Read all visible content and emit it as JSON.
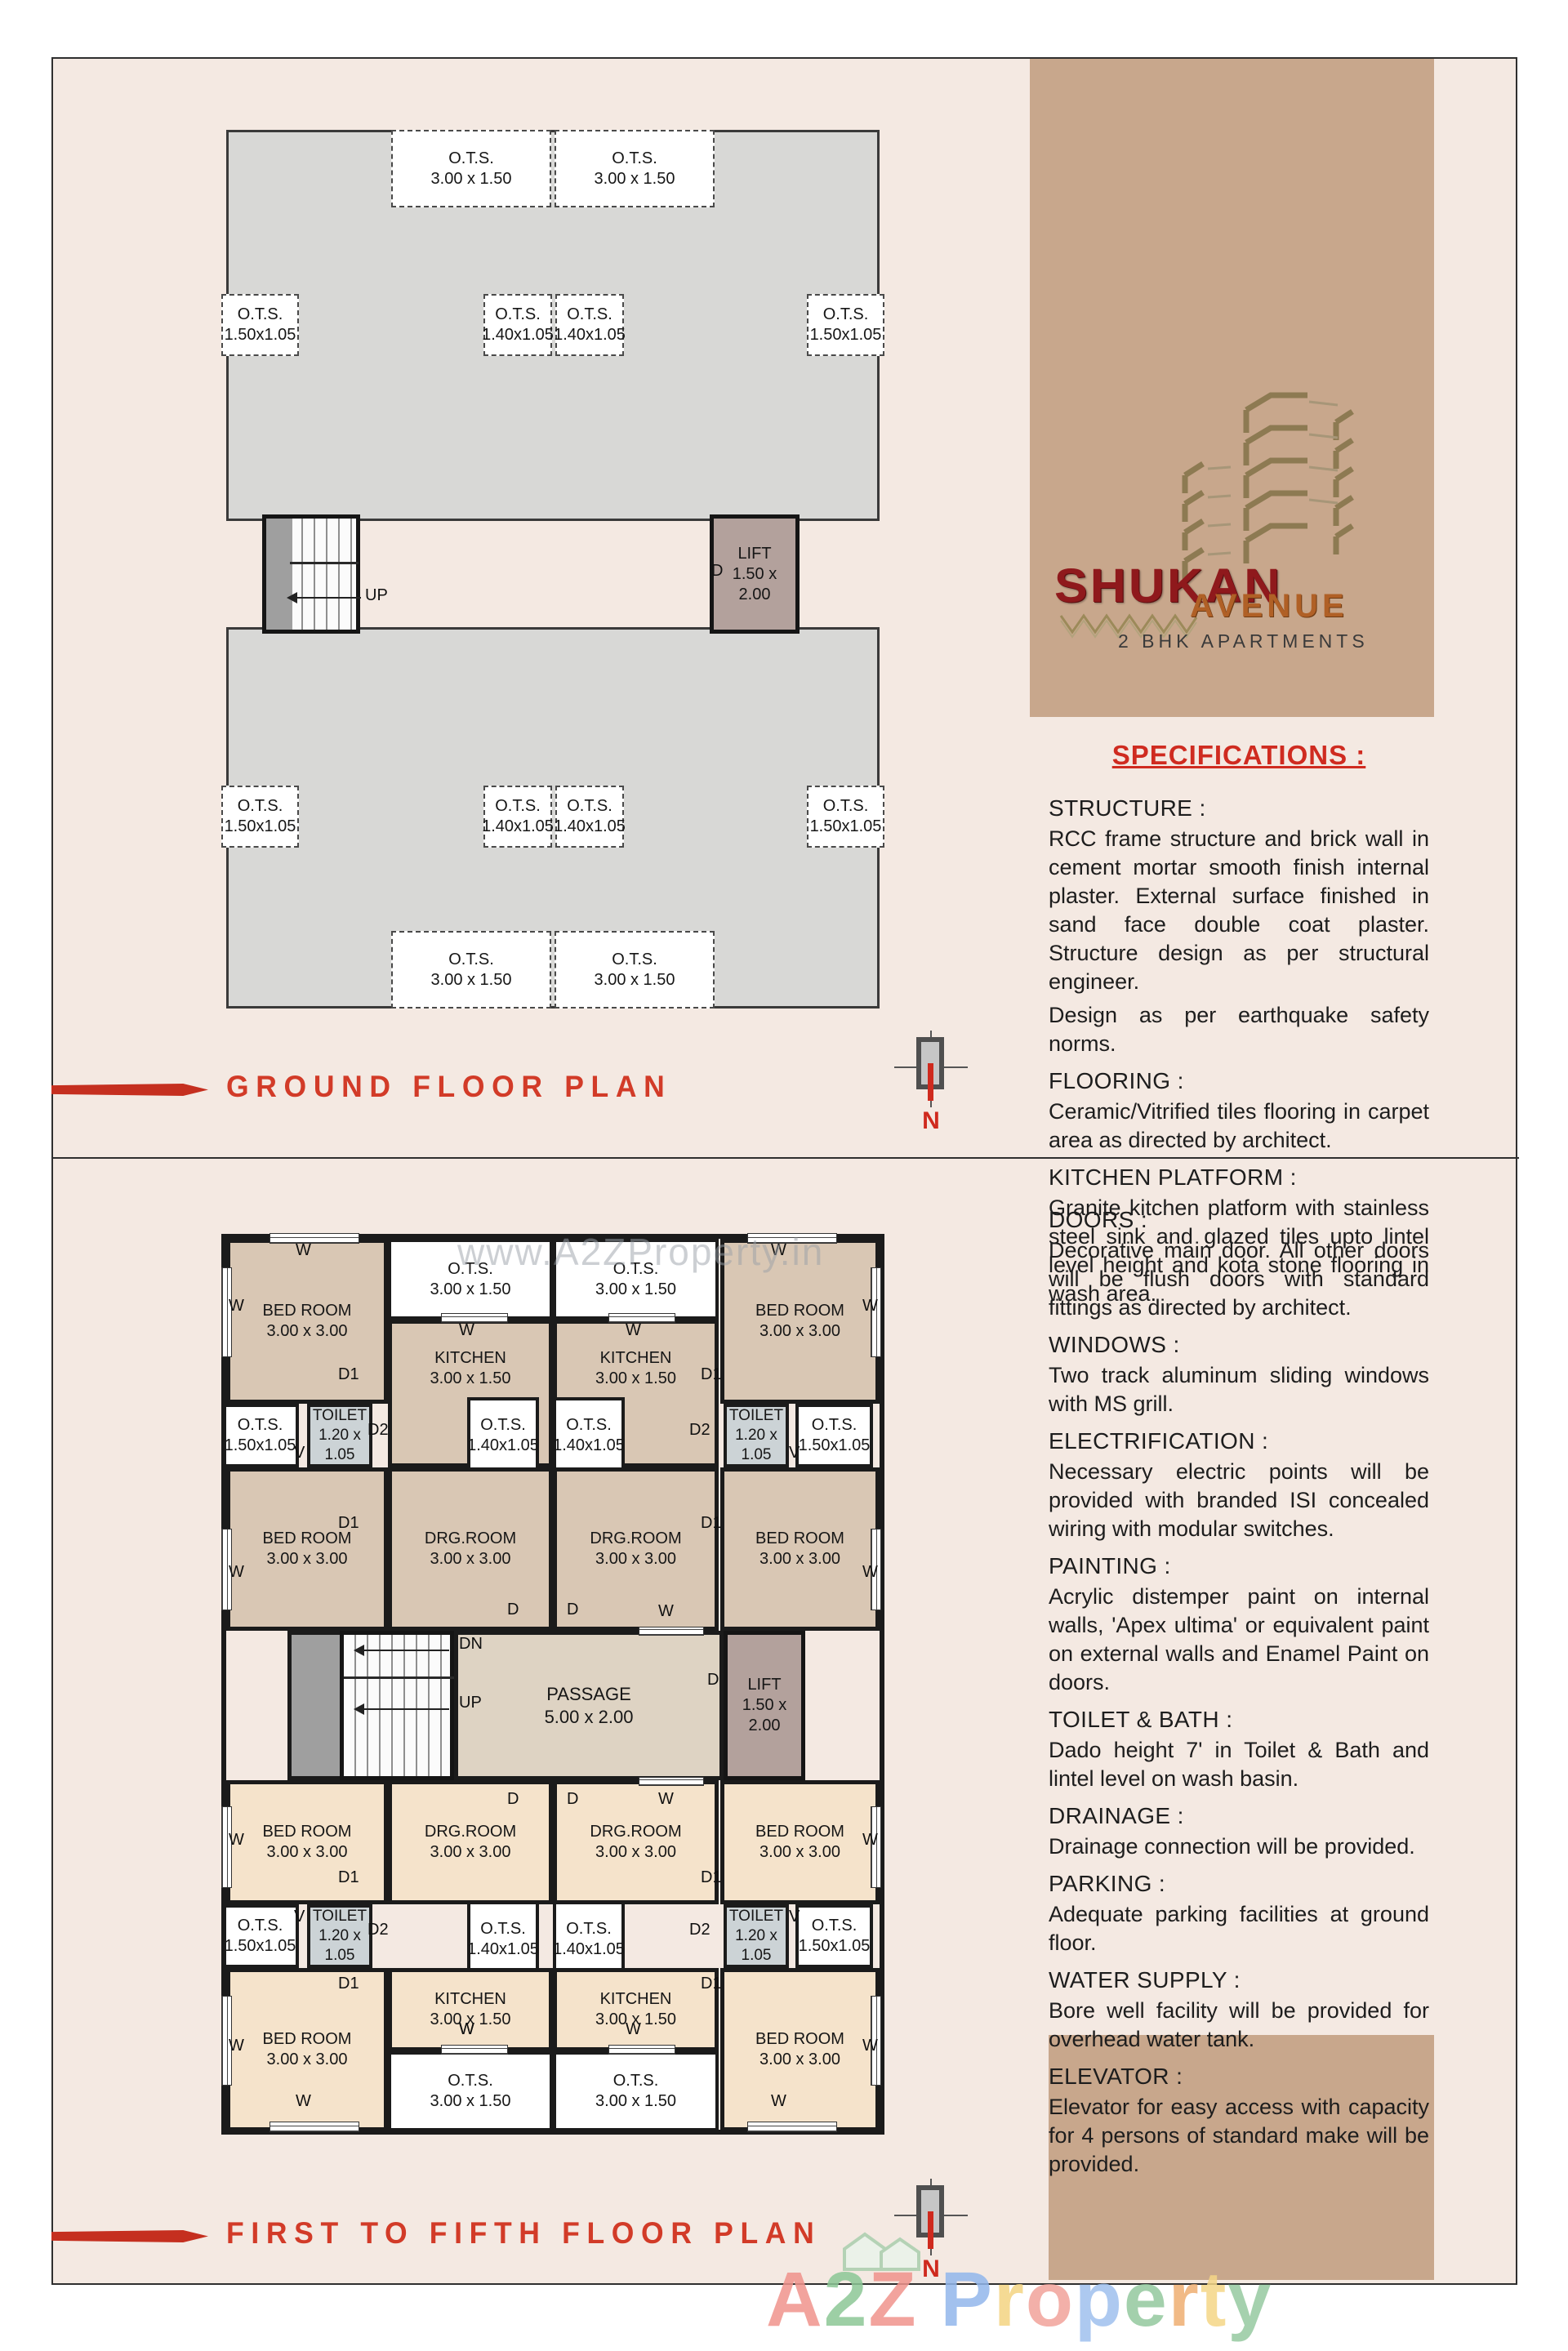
{
  "page": {
    "panel_bg": "#f4e9e2",
    "tan": "#c8a78c",
    "accent_red": "#d23b28",
    "wall": "#1b1b1b"
  },
  "logo": {
    "brand": "SHUKAN",
    "brand2": "AVENUE",
    "tagline": "2 BHK APARTMENTS"
  },
  "titles": {
    "ground": "GROUND FLOOR PLAN",
    "upper": "FIRST TO FIFTH FLOOR PLAN",
    "north": "N"
  },
  "legend": {
    "window": "W",
    "door": "D",
    "door1": "D1",
    "door2": "D2",
    "vent": "V",
    "up": "UP",
    "down": "DN"
  },
  "watermarks": {
    "plan": "www.A2ZProperty.in",
    "bottom": [
      {
        "ch": "A",
        "c": "#f0938c"
      },
      {
        "ch": "2",
        "c": "#8cc796"
      },
      {
        "ch": "Z",
        "c": "#f0938c"
      },
      {
        "ch": " ",
        "c": "#ffffff"
      },
      {
        "ch": "P",
        "c": "#92b7ec"
      },
      {
        "ch": "r",
        "c": "#f4d482"
      },
      {
        "ch": "o",
        "c": "#f2a39b"
      },
      {
        "ch": "p",
        "c": "#9fc0ee"
      },
      {
        "ch": "e",
        "c": "#93c89e"
      },
      {
        "ch": "r",
        "c": "#efae72"
      },
      {
        "ch": "t",
        "c": "#f5d687"
      },
      {
        "ch": "y",
        "c": "#96c9a0"
      }
    ]
  },
  "specifications": {
    "heading": "SPECIFICATIONS :",
    "top": [
      {
        "label": "STRUCTURE :",
        "body": "RCC frame structure and brick wall in cement mortar smooth finish internal plaster. External surface finished in sand face double coat plaster. Structure design as per structural engineer."
      },
      {
        "label": "",
        "body": "Design as per earthquake safety norms."
      },
      {
        "label": "FLOORING :",
        "body": "Ceramic/Vitrified tiles flooring in carpet area as directed by architect."
      },
      {
        "label": "KITCHEN PLATFORM :",
        "body": "Granite kitchen platform with stainless steel sink and glazed tiles upto lintel level height and kota stone flooring in wash area."
      }
    ],
    "bottom": [
      {
        "label": "DOORS :",
        "body": "Decorative main door. All other doors will be flush doors with standard fittings as directed by architect."
      },
      {
        "label": "WINDOWS :",
        "body": "Two track aluminum sliding windows with MS grill."
      },
      {
        "label": "ELECTRIFICATION :",
        "body": "Necessary electric points will be provided with branded ISI concealed wiring with modular switches."
      },
      {
        "label": "PAINTING :",
        "body": "Acrylic distemper paint on internal walls, 'Apex ultima' or equivalent paint on external walls and Enamel Paint on doors."
      },
      {
        "label": "TOILET & BATH :",
        "body": "Dado height 7' in Toilet & Bath and lintel level on wash basin."
      },
      {
        "label": "DRAINAGE :",
        "body": "Drainage connection will be provided."
      },
      {
        "label": "PARKING :",
        "body": "Adequate parking facilities at ground floor."
      },
      {
        "label": "WATER SUPPLY :",
        "body": "Bore well facility will be provided for overhead water tank."
      },
      {
        "label": "ELEVATOR :",
        "body": "Elevator for easy access with capacity for 4 persons of standard make will be provided."
      }
    ]
  },
  "ground_plan": {
    "boxes": [
      {
        "id": "g-ots-t1",
        "lines": [
          "O.T.S.",
          "3.00 x 1.50"
        ]
      },
      {
        "id": "g-ots-t2",
        "lines": [
          "O.T.S.",
          "3.00 x 1.50"
        ]
      },
      {
        "id": "g-ots-m1",
        "lines": [
          "O.T.S.",
          "1.50x1.05"
        ]
      },
      {
        "id": "g-ots-m2",
        "lines": [
          "O.T.S.",
          "1.40x1.05"
        ]
      },
      {
        "id": "g-ots-m3",
        "lines": [
          "O.T.S.",
          "1.40x1.05"
        ]
      },
      {
        "id": "g-ots-m4",
        "lines": [
          "O.T.S.",
          "1.50x1.05"
        ]
      },
      {
        "id": "g-ots-b1",
        "lines": [
          "O.T.S.",
          "1.50x1.05"
        ]
      },
      {
        "id": "g-ots-b2",
        "lines": [
          "O.T.S.",
          "1.40x1.05"
        ]
      },
      {
        "id": "g-ots-b3",
        "lines": [
          "O.T.S.",
          "1.40x1.05"
        ]
      },
      {
        "id": "g-ots-b4",
        "lines": [
          "O.T.S.",
          "1.50x1.05"
        ]
      },
      {
        "id": "g-ots-bot1",
        "lines": [
          "O.T.S.",
          "3.00 x 1.50"
        ]
      },
      {
        "id": "g-ots-bot2",
        "lines": [
          "O.T.S.",
          "3.00 x 1.50"
        ]
      },
      {
        "id": "g-lift",
        "lines": [
          "LIFT",
          "1.50 x",
          "2.00"
        ]
      }
    ]
  },
  "floor_plan": {
    "boxes": [
      {
        "id": "f-bed-tl",
        "lines": [
          "BED ROOM",
          "3.00 x 3.00"
        ]
      },
      {
        "id": "f-bed-tr",
        "lines": [
          "BED ROOM",
          "3.00 x 3.00"
        ]
      },
      {
        "id": "f-ots-t1",
        "lines": [
          "O.T.S.",
          "3.00 x 1.50"
        ]
      },
      {
        "id": "f-ots-t2",
        "lines": [
          "O.T.S.",
          "3.00 x 1.50"
        ]
      },
      {
        "id": "f-kit-l",
        "lines": [
          "KITCHEN",
          "3.00 x 1.50"
        ]
      },
      {
        "id": "f-kit-r",
        "lines": [
          "KITCHEN",
          "3.00 x 1.50"
        ]
      },
      {
        "id": "f-ots-r1a",
        "lines": [
          "O.T.S.",
          "1.50x1.05"
        ]
      },
      {
        "id": "f-toi-1l",
        "lines": [
          "TOILET",
          "1.20 x",
          "1.05"
        ]
      },
      {
        "id": "f-ots-r1b",
        "lines": [
          "O.T.S.",
          "1.40x1.05"
        ]
      },
      {
        "id": "f-ots-r1c",
        "lines": [
          "O.T.S.",
          "1.40x1.05"
        ]
      },
      {
        "id": "f-toi-1r",
        "lines": [
          "TOILET",
          "1.20 x",
          "1.05"
        ]
      },
      {
        "id": "f-ots-r1d",
        "lines": [
          "O.T.S.",
          "1.50x1.05"
        ]
      },
      {
        "id": "f-bed-2l",
        "lines": [
          "BED ROOM",
          "3.00 x 3.00"
        ]
      },
      {
        "id": "f-drg-l",
        "lines": [
          "DRG.ROOM",
          "3.00 x 3.00"
        ]
      },
      {
        "id": "f-drg-r",
        "lines": [
          "DRG.ROOM",
          "3.00 x 3.00"
        ]
      },
      {
        "id": "f-bed-2r",
        "lines": [
          "BED ROOM",
          "3.00 x 3.00"
        ]
      },
      {
        "id": "f-landing",
        "lines": []
      },
      {
        "id": "f-stairs",
        "lines": []
      },
      {
        "id": "f-passage",
        "lines": [
          "PASSAGE",
          "5.00 x 2.00"
        ]
      },
      {
        "id": "f-lift",
        "lines": [
          "LIFT",
          "1.50 x",
          "2.00"
        ]
      },
      {
        "id": "f-bed-3l",
        "lines": [
          "BED ROOM",
          "3.00 x 3.00"
        ]
      },
      {
        "id": "f-drg-2l",
        "lines": [
          "DRG.ROOM",
          "3.00 x 3.00"
        ]
      },
      {
        "id": "f-drg-2r",
        "lines": [
          "DRG.ROOM",
          "3.00 x 3.00"
        ]
      },
      {
        "id": "f-bed-3r",
        "lines": [
          "BED ROOM",
          "3.00 x 3.00"
        ]
      },
      {
        "id": "f-ots-r2a",
        "lines": [
          "O.T.S.",
          "1.50x1.05"
        ]
      },
      {
        "id": "f-toi-2l",
        "lines": [
          "TOILET",
          "1.20 x",
          "1.05"
        ]
      },
      {
        "id": "f-ots-r2b",
        "lines": [
          "O.T.S.",
          "1.40x1.05"
        ]
      },
      {
        "id": "f-ots-r2c",
        "lines": [
          "O.T.S.",
          "1.40x1.05"
        ]
      },
      {
        "id": "f-toi-2r",
        "lines": [
          "TOILET",
          "1.20 x",
          "1.05"
        ]
      },
      {
        "id": "f-ots-r2d",
        "lines": [
          "O.T.S.",
          "1.50x1.05"
        ]
      },
      {
        "id": "f-bed-4l",
        "lines": [
          "BED ROOM",
          "3.00 x 3.00"
        ]
      },
      {
        "id": "f-kit-2l",
        "lines": [
          "KITCHEN",
          "3.00 x 1.50"
        ]
      },
      {
        "id": "f-kit-2r",
        "lines": [
          "KITCHEN",
          "3.00 x 1.50"
        ]
      },
      {
        "id": "f-bed-4r",
        "lines": [
          "BED ROOM",
          "3.00 x 3.00"
        ]
      },
      {
        "id": "f-ots-b1",
        "lines": [
          "O.T.S.",
          "3.00 x 1.50"
        ]
      },
      {
        "id": "f-ots-b2",
        "lines": [
          "O.T.S.",
          "3.00 x 1.50"
        ]
      }
    ]
  }
}
